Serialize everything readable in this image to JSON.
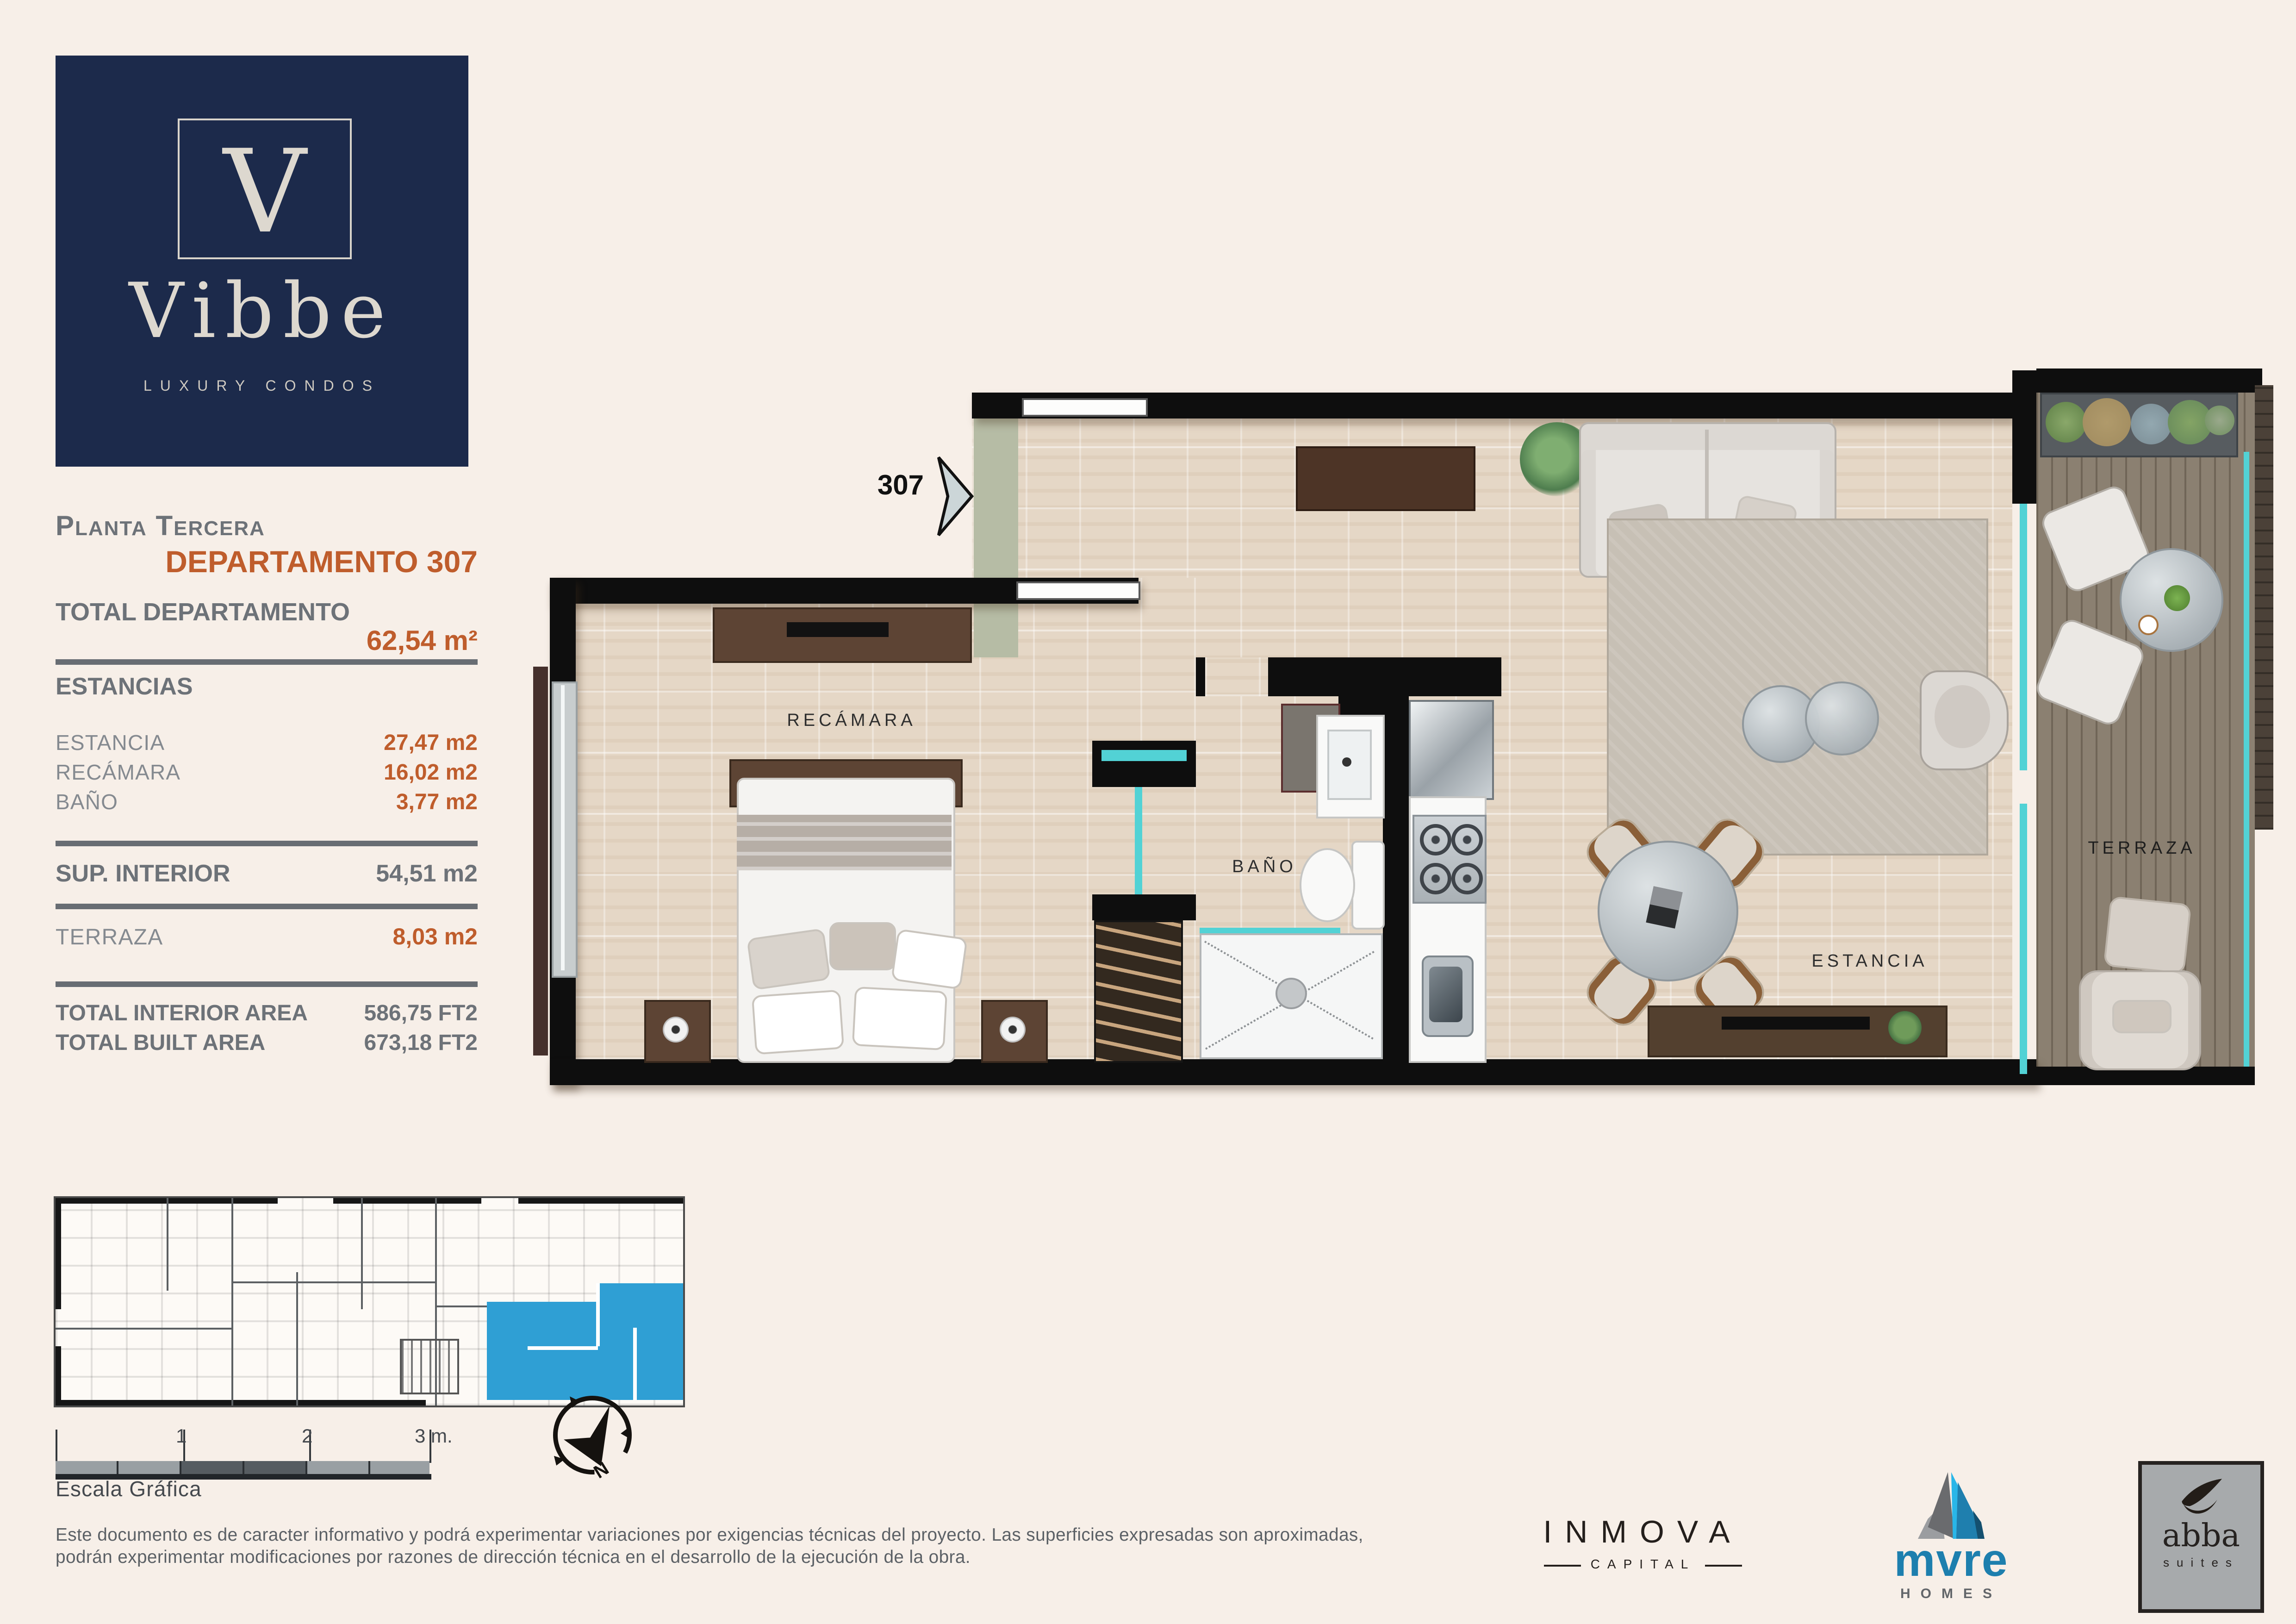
{
  "brand": {
    "monogram": "V",
    "name": "Vibbe",
    "tagline": "LUXURY CONDOS"
  },
  "info_panel": {
    "floor_label": "Planta Tercera",
    "unit_label": "DEPARTAMENTO 307",
    "total_label": "TOTAL DEPARTAMENTO",
    "total_value": "62,54 m²",
    "rooms_section_label": "ESTANCIAS",
    "room_rows": [
      {
        "label": "ESTANCIA",
        "value": "27,47 m2"
      },
      {
        "label": "RECÁMARA",
        "value": "16,02 m2"
      },
      {
        "label": "BAÑO",
        "value": "3,77 m2"
      }
    ],
    "sup_interior": {
      "label": "SUP. INTERIOR",
      "value": "54,51 m2"
    },
    "terraza": {
      "label": "TERRAZA",
      "value": "8,03 m2"
    },
    "totals": [
      {
        "label": "TOTAL INTERIOR AREA",
        "value": "586,75 FT2"
      },
      {
        "label": "TOTAL BUILT AREA",
        "value": "673,18 FT2"
      }
    ]
  },
  "plan": {
    "unit_number": "307",
    "rooms": {
      "bedroom": "RECÁMARA",
      "bath": "BAÑO",
      "living": "ESTANCIA",
      "terrace": "TERRAZA"
    }
  },
  "key_plan": {
    "scale_title": "Escala Gráfica",
    "scale_ticks": [
      "1",
      "2",
      "3 m."
    ],
    "compass_label": "N"
  },
  "footer": {
    "disclaimer_line1": "Este documento es de caracter informativo y podrá experimentar variaciones por exigencias técnicas del proyecto. Las superficies expresadas son aproximadas,",
    "disclaimer_line2": "podrán experimentar modificaciones por razones de dirección técnica en el desarrollo de la ejecución de la obra.",
    "logos": {
      "inmova": {
        "name": "INMOVA",
        "sub": "CAPITAL"
      },
      "mvre": {
        "name": "mvre",
        "sub": "HOMES"
      },
      "abba": {
        "name": "abba",
        "sub": "suites"
      }
    }
  },
  "colors": {
    "navy": "#1c2a4b",
    "orange": "#bf5d2c",
    "gray_text": "#6d7278",
    "teal": "#52d2d5",
    "cream_bg": "#f7efe8",
    "wall_black": "#0e0e0e",
    "wood_brown": "#5d4434",
    "deck": "#8b8071",
    "highlight_blue": "#2f9fd4",
    "mvre_blue": "#1d7fae"
  }
}
